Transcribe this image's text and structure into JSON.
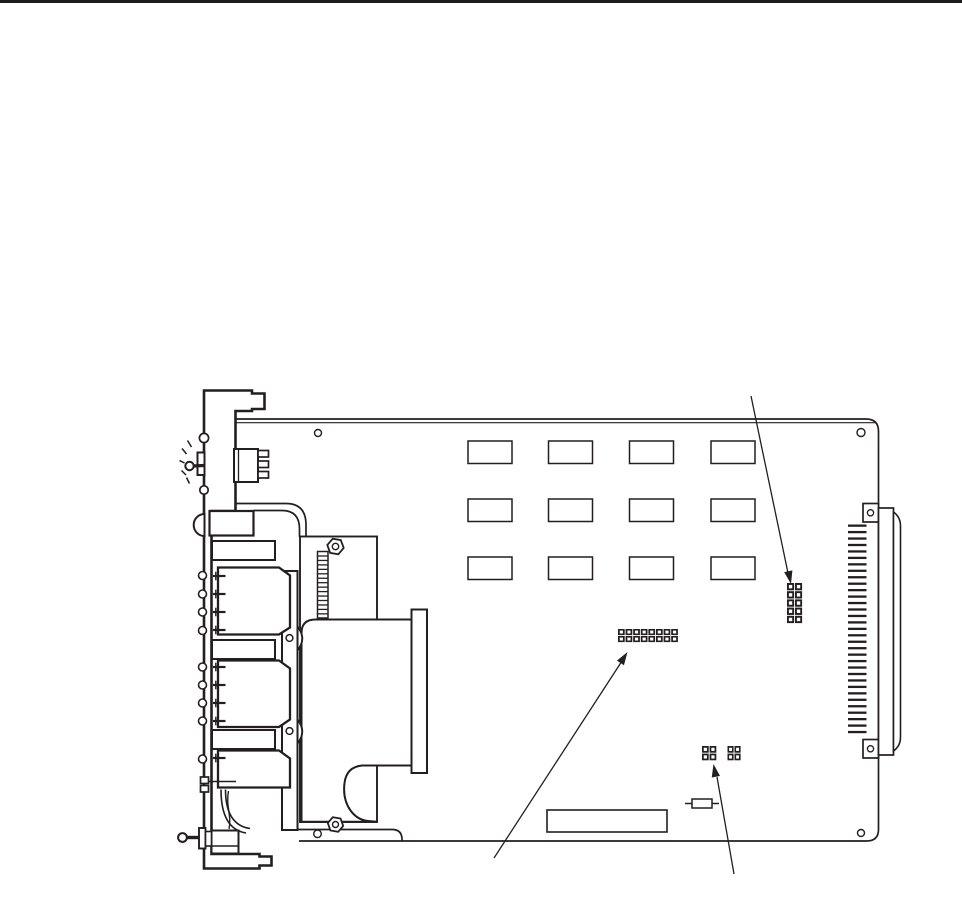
{
  "page": {
    "background": "#ffffff",
    "top_rule_color": "#1c1c1c"
  },
  "figure": {
    "subject": "printed-circuit-card-assembly-line-drawing",
    "stroke_color": "#231f20",
    "fill_color": "#ffffff"
  },
  "drawing": {
    "ic_grid": {
      "rows": 3,
      "cols": 4,
      "col_x": [
        468,
        548.5,
        629.5,
        711
      ],
      "row_y": [
        441,
        499,
        557
      ],
      "w": 44,
      "h": 22.5
    },
    "edge_connector_pins": {
      "count": 33,
      "x": 848,
      "w": 18.5,
      "y0": 524.5,
      "pitch": 6.45,
      "h": 2.3
    },
    "header_ladder": {
      "rungs": 14,
      "x1": 318,
      "x2": 327.5,
      "y0": 556,
      "pitch": 4.45
    },
    "jumper_blocks": [
      {
        "name": "jumper-block-right",
        "x": 787,
        "y": 583,
        "cols": 2,
        "rows": 5,
        "cellW": 8,
        "cellH": 8.2
      },
      {
        "name": "jumper-block-center",
        "x": 618,
        "y": 629,
        "cols": 8,
        "rows": 2,
        "cellW": 7.6,
        "cellH": 7
      },
      {
        "name": "jumper-block-small-left",
        "x": 702,
        "y": 746,
        "cols": 2,
        "rows": 2,
        "cellW": 7.6,
        "cellH": 7.6
      },
      {
        "name": "jumper-block-small-right",
        "x": 727.5,
        "y": 746,
        "cols": 2,
        "rows": 2,
        "cellW": 7,
        "cellH": 7.6
      }
    ],
    "callout_arrows": [
      {
        "name": "arrow-to-right-jumper-block",
        "x1": 751,
        "y1": 396,
        "x2": 788,
        "y2": 573,
        "tipx": 791,
        "tipy": 584
      },
      {
        "name": "arrow-to-center-jumper-block",
        "x1": 494,
        "y1": 858,
        "x2": 622,
        "y2": 661,
        "tipx": 627.5,
        "tipy": 652
      },
      {
        "name": "arrow-to-small-jumper-block",
        "x1": 734,
        "y1": 874,
        "x2": 717,
        "y2": 777,
        "tipx": 713.5,
        "tipy": 764
      }
    ],
    "jack_pin_groups": [
      [
        576,
        594,
        612,
        630
      ],
      [
        667,
        685,
        703,
        721
      ],
      [
        758
      ]
    ],
    "plate_circles": {
      "x": 202.5,
      "r": 4,
      "ys": [
        575.5,
        594,
        612,
        630.5,
        667,
        685,
        703,
        721,
        759
      ]
    },
    "burst_dashes": [
      [
        187.5,
        440.5,
        191.5,
        447
      ],
      [
        182,
        448.5,
        186.5,
        454
      ],
      [
        179.5,
        460.5,
        184.5,
        463
      ],
      [
        181.5,
        470.5,
        186,
        475
      ],
      [
        186.5,
        477.5,
        189.5,
        483.5
      ]
    ],
    "hex_nuts": [
      {
        "cx": 335.5,
        "cy": 546.5,
        "r": 8.3,
        "ir": 3.2,
        "slot": "top"
      },
      {
        "cx": 335.5,
        "cy": 824.5,
        "r": 7.8,
        "ir": 3.0,
        "slot": "bottom"
      }
    ]
  }
}
